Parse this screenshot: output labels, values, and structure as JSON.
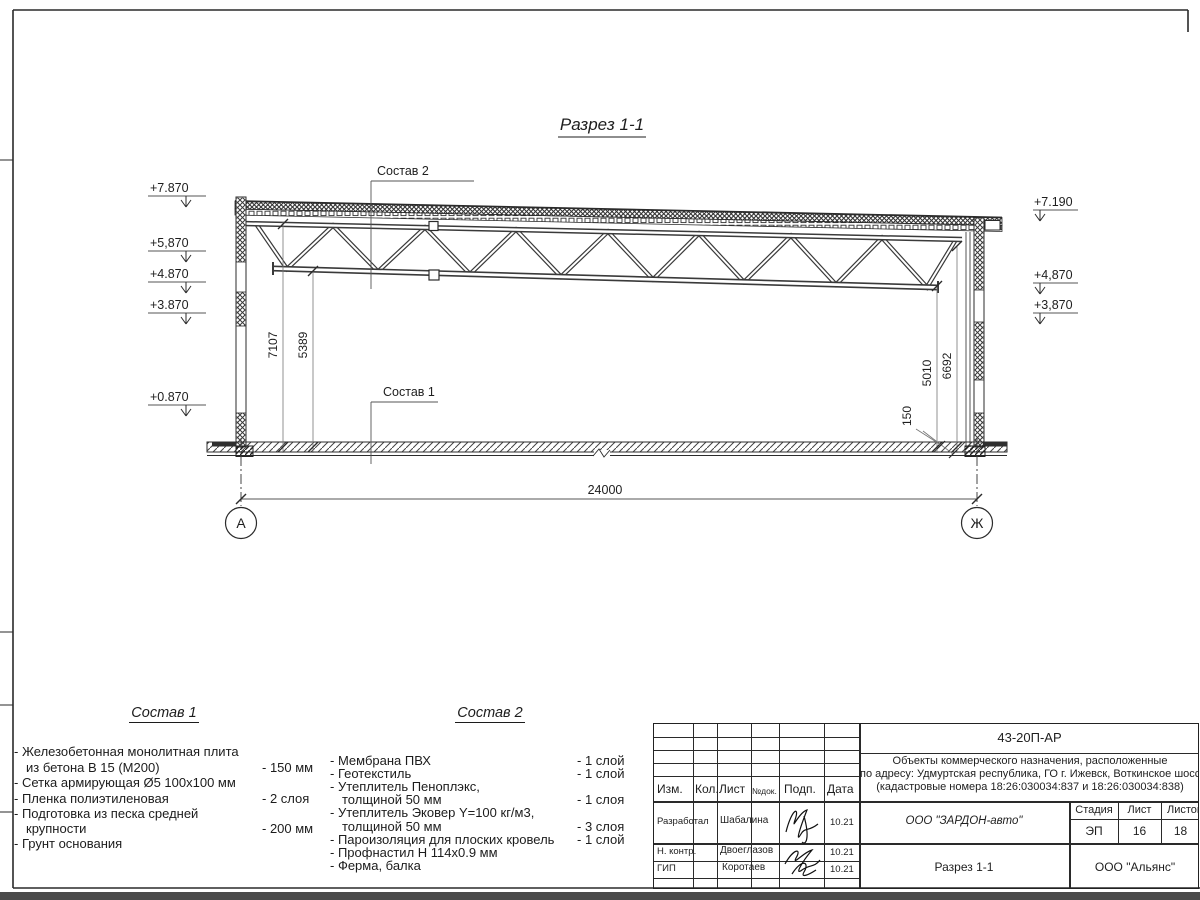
{
  "section": {
    "title": "Разрез 1-1",
    "callout1": "Состав 1",
    "callout2": "Состав 2",
    "elev_left": [
      "+7.870",
      "+5,870",
      "+4.870",
      "+3.870",
      "+0.870"
    ],
    "elev_right": [
      "+7.190",
      "+4,870",
      "+3,870"
    ],
    "dim_left_top": "7107",
    "dim_left_bottom": "5389",
    "dim_right_bottom": "5010",
    "dim_right_top": "6692",
    "dim_slab": "150",
    "dim_span": "24000",
    "axis_left": "А",
    "axis_right": "Ж"
  },
  "list1": {
    "title": "Состав 1",
    "lines": [
      {
        "t": "- Железобетонная  монолитная плита",
        "v": ""
      },
      {
        "t": "из бетона В 15 (М200)",
        "v": "- 150 мм"
      },
      {
        "t": "- Сетка армирующая Ø5 100х100 мм",
        "v": ""
      },
      {
        "t": "- Пленка полиэтиленовая",
        "v": "-  2 слоя"
      },
      {
        "t": "- Подготовка из песка средней",
        "v": ""
      },
      {
        "t": "крупности",
        "v": "- 200 мм"
      },
      {
        "t": "- Грунт основания",
        "v": ""
      }
    ]
  },
  "list2": {
    "title": "Состав 2",
    "lines": [
      {
        "t": "- Мембрана ПВХ",
        "v": "- 1 слой"
      },
      {
        "t": "- Геотекстиль",
        "v": "- 1 слой"
      },
      {
        "t": "- Утеплитель Пеноплэкс,",
        "v": ""
      },
      {
        "t": "толщиной 50 мм",
        "v": "- 1 слоя"
      },
      {
        "t": "- Утеплитель Эковер Y=100 кг/м3,",
        "v": ""
      },
      {
        "t": "толщиной 50 мм",
        "v": "- 3 слоя"
      },
      {
        "t": "- Пароизоляция для плоских кровель",
        "v": "- 1 слой"
      },
      {
        "t": "- Профнастил Н 114х0.9 мм",
        "v": ""
      },
      {
        "t": "- Ферма, балка",
        "v": ""
      }
    ]
  },
  "titleblock": {
    "doc_number": "43-20П-АР",
    "project_line1": "Объекты коммерческого назначения, расположенные",
    "project_line2": "по адресу: Удмуртская республика, ГО г. Ижевск, Воткинское шоссе",
    "project_line3": "(кадастровые номера 18:26:030034:837 и 18:26:030034:838)",
    "headers": {
      "izm": "Изм.",
      "kol": "Кол.",
      "list": "Лист",
      "ndok": "№док.",
      "podp": "Подп.",
      "data": "Дата"
    },
    "rows": [
      {
        "role": "Разработал",
        "name": "Шабалина",
        "date": "10.21"
      },
      {
        "role": "Н. контр.",
        "name": "Двоеглазов",
        "date": "10.21"
      },
      {
        "role": "ГИП",
        "name": "Коротаев",
        "date": "10.21"
      }
    ],
    "company": "ООО \"ЗАРДОН-авто\"",
    "stage_label": "Стадия",
    "sheet_label": "Лист",
    "sheets_label": "Листов",
    "stage": "ЭП",
    "sheet": "16",
    "sheets": "18",
    "section_name": "Разрез 1-1",
    "org": "ООО \"Альянс\""
  }
}
